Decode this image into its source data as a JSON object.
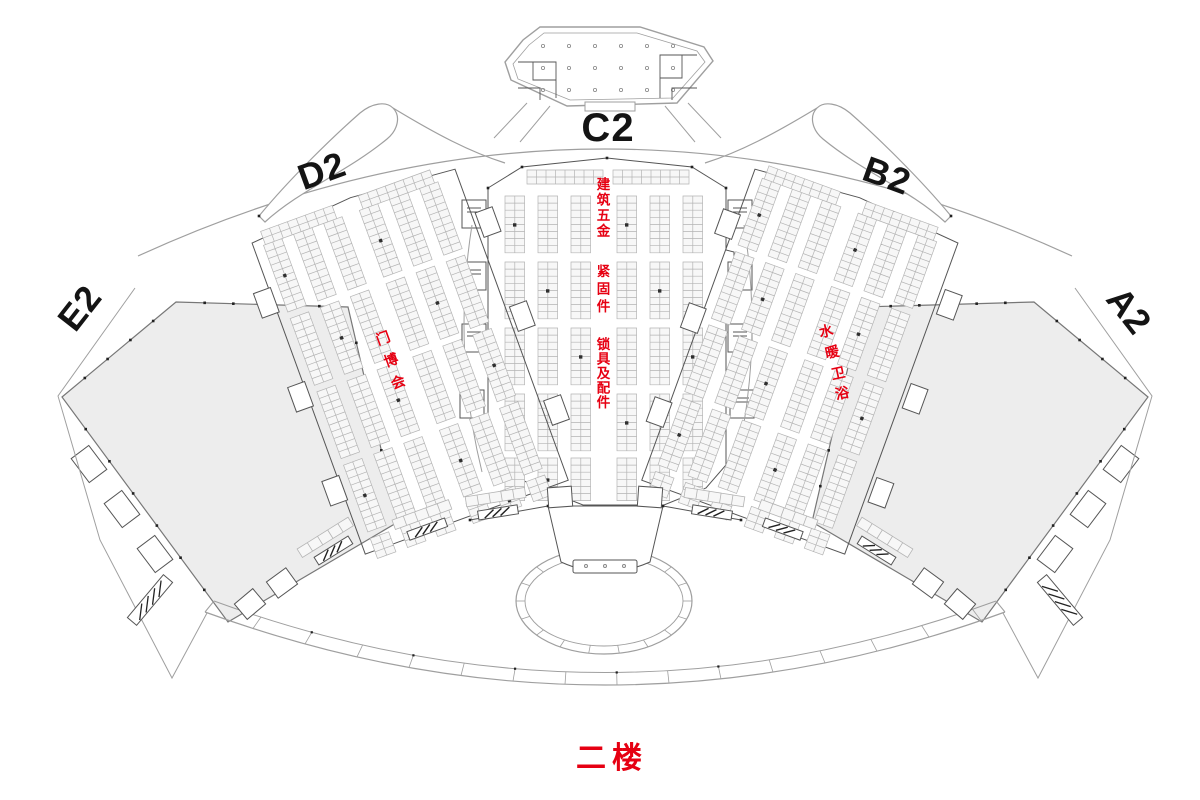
{
  "floor_title": "二楼",
  "halls": {
    "c2": "C2",
    "d2": "D2",
    "b2": "B2",
    "e2": "E2",
    "a2": "A2"
  },
  "zones": {
    "c2_lines": [
      "建筑五金",
      "紧固件",
      "锁具及配件"
    ],
    "d2": "门博会",
    "b2": "水暖卫浴"
  },
  "colors": {
    "red": "#e60012",
    "hall_fill": "#ededed",
    "wall": "#555555",
    "wall_light": "#9f9f9f",
    "booth_stroke": "#b4b4b4",
    "booth_fill": "#f7f7f7",
    "pillar": "#2f2f2f"
  }
}
